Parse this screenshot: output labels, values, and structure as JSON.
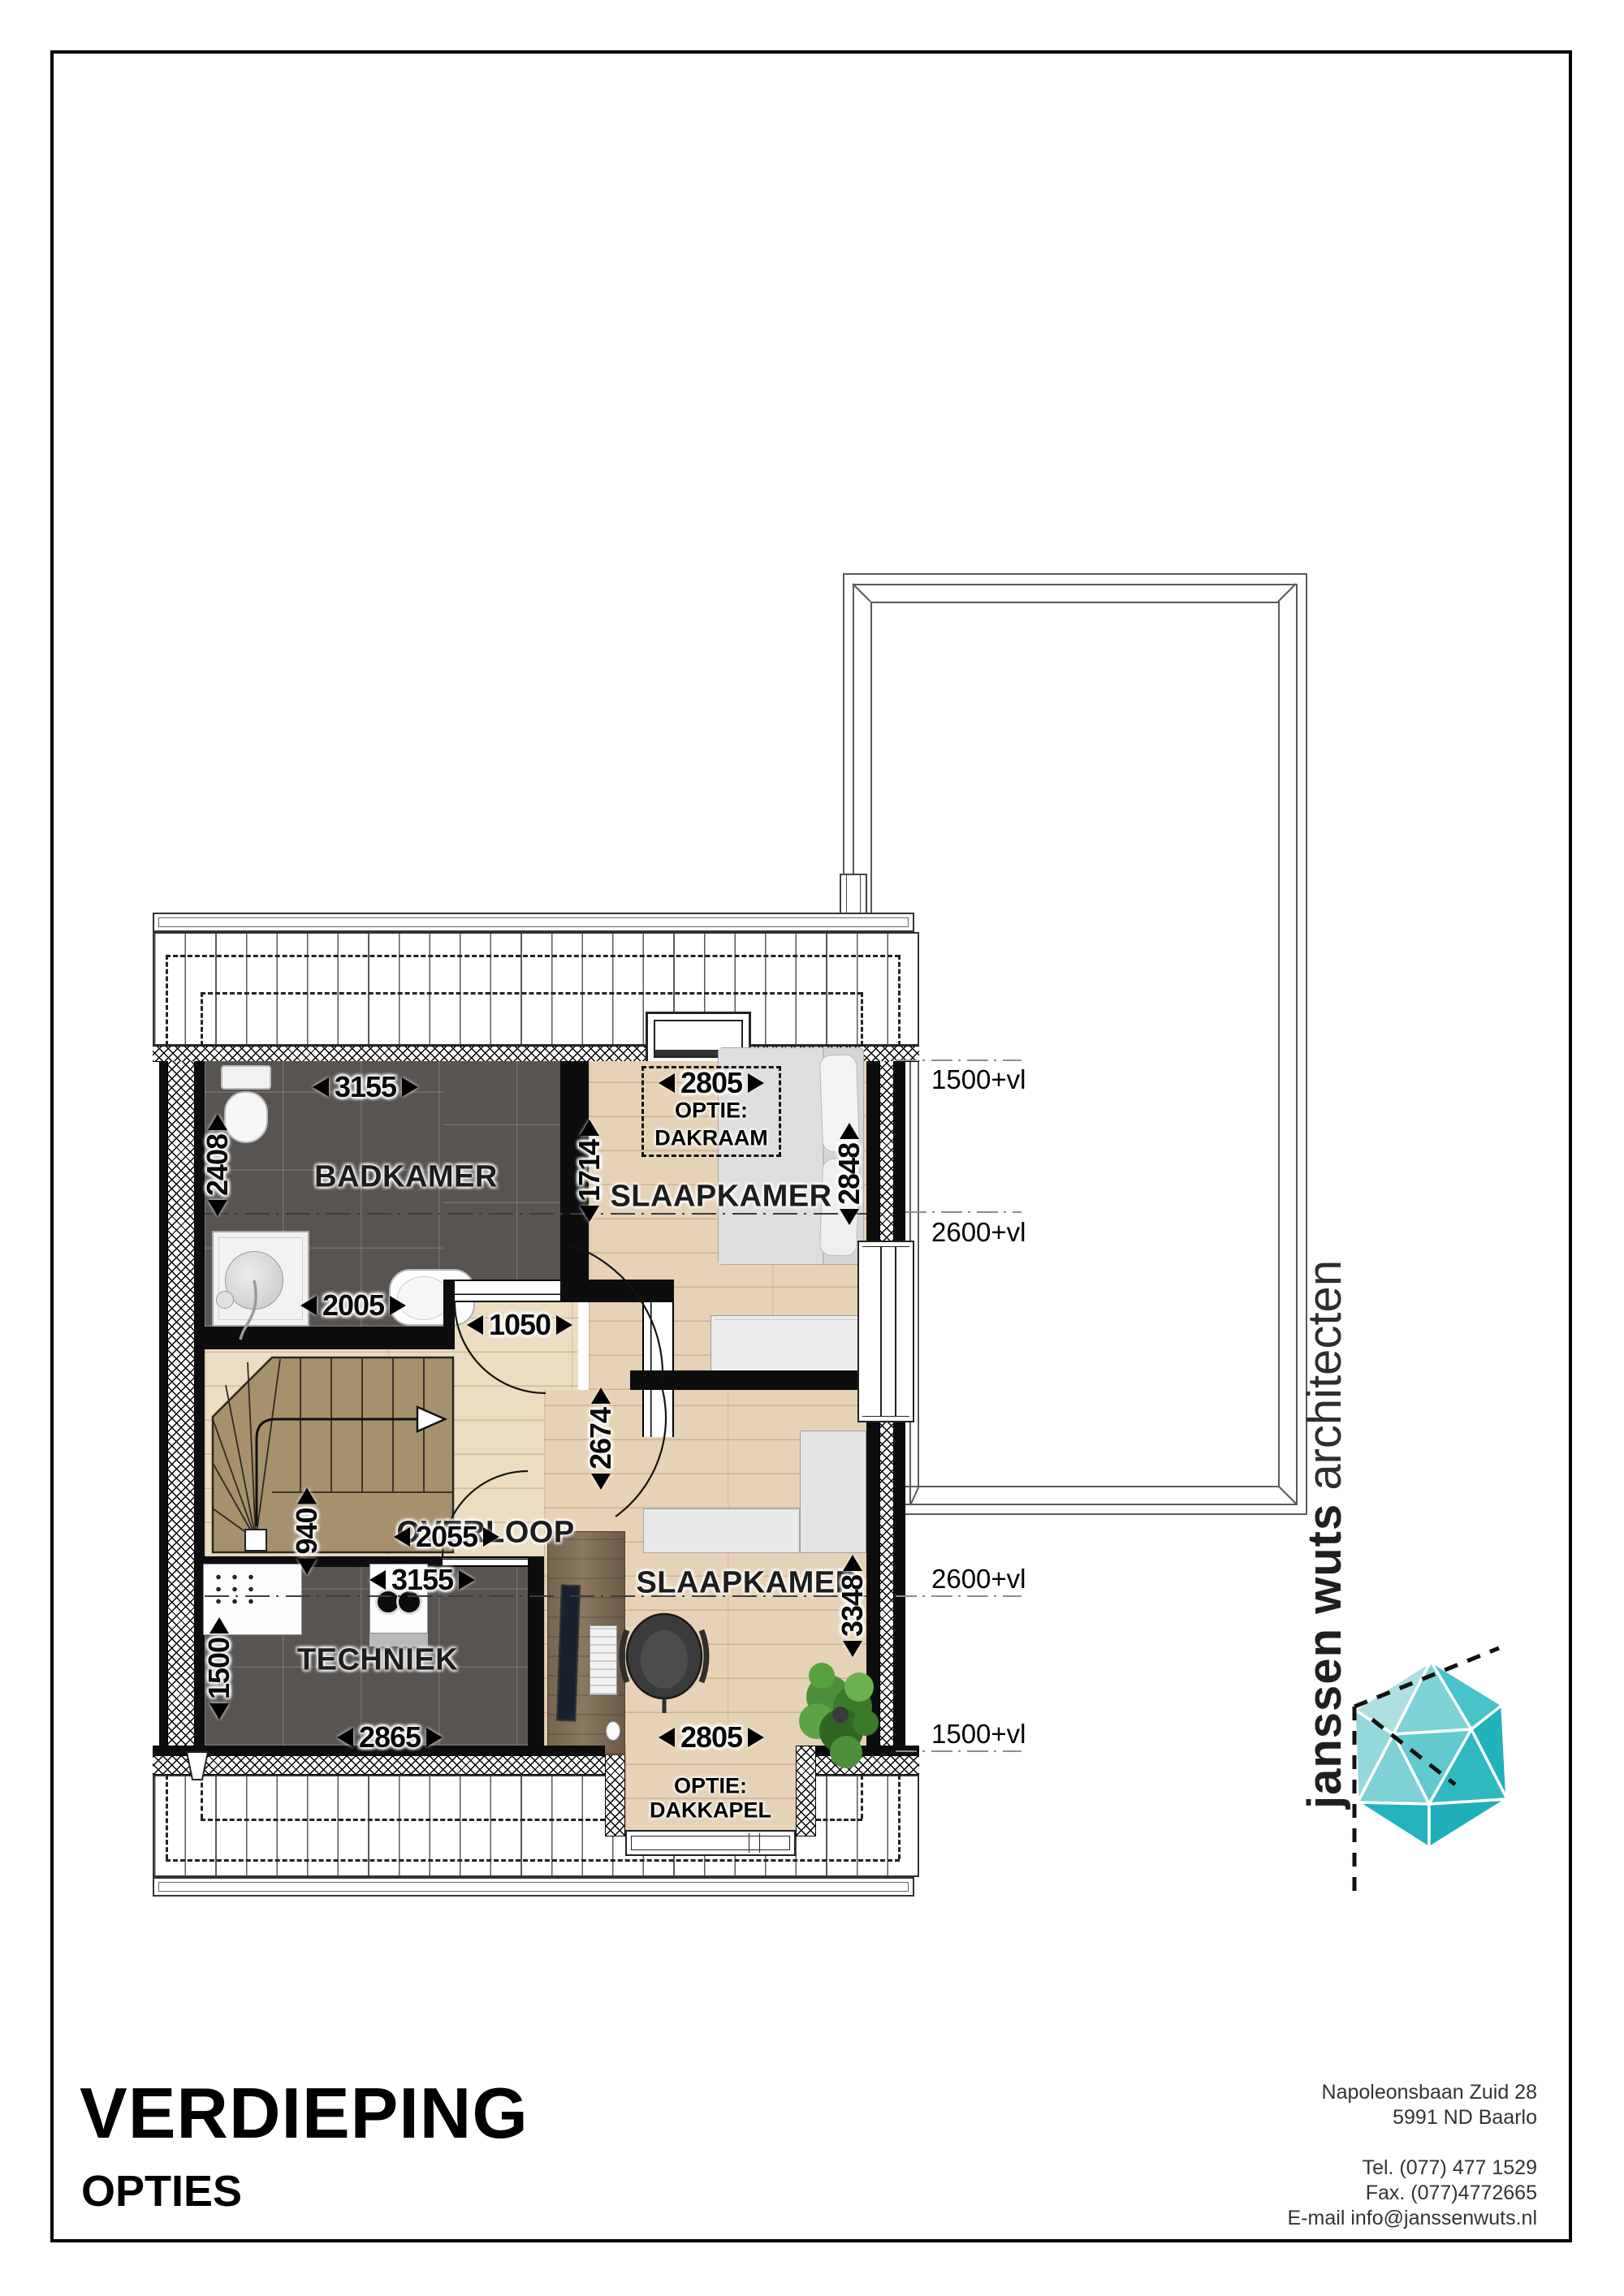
{
  "page": {
    "title": "VERDIEPING",
    "subtitle": "OPTIES"
  },
  "address": {
    "street": "Napoleonsbaan Zuid 28",
    "city": "5991 ND Baarlo",
    "tel": "Tel. (077) 477 1529",
    "fax": "Fax. (077)4772665",
    "email": "E-mail info@janssenwuts.nl"
  },
  "logo": {
    "bold": "janssen wuts",
    "light": "architecten"
  },
  "rooms": {
    "bathroom": "BADKAMER",
    "bedroom1": "SLAAPKAMER",
    "landing": "OVERLOOP",
    "tech": "TECHNIEK",
    "bedroom2": "SLAAPKAMER"
  },
  "options": {
    "label1": "OPTIE:",
    "name1": "DAKRAAM",
    "label2": "OPTIE:",
    "name2": "DAKKAPEL"
  },
  "levels": {
    "l1": "1500+vl",
    "l2": "2600+vl",
    "l3": "2600+vl",
    "l4": "1500+vl"
  },
  "dims": {
    "bathroom_width": "3155",
    "bathroom_depth": "2408",
    "bathroom_right": "1714",
    "shower": "2005",
    "bedroom1_width": "2805",
    "bedroom1_depth": "2848",
    "door": "1050",
    "landing_depth": "2674",
    "landing_width": "2055",
    "stairs": "940",
    "tech_width": "3155",
    "tech_left": "1500",
    "tech_bottom": "2865",
    "bedroom2_depth": "3348",
    "bedroom2_width": "2805"
  },
  "colors": {
    "accent_teal": "#2db8c0",
    "tile": "#585451",
    "wood": "#e6d2b6",
    "wall": "#0d0d0d"
  }
}
